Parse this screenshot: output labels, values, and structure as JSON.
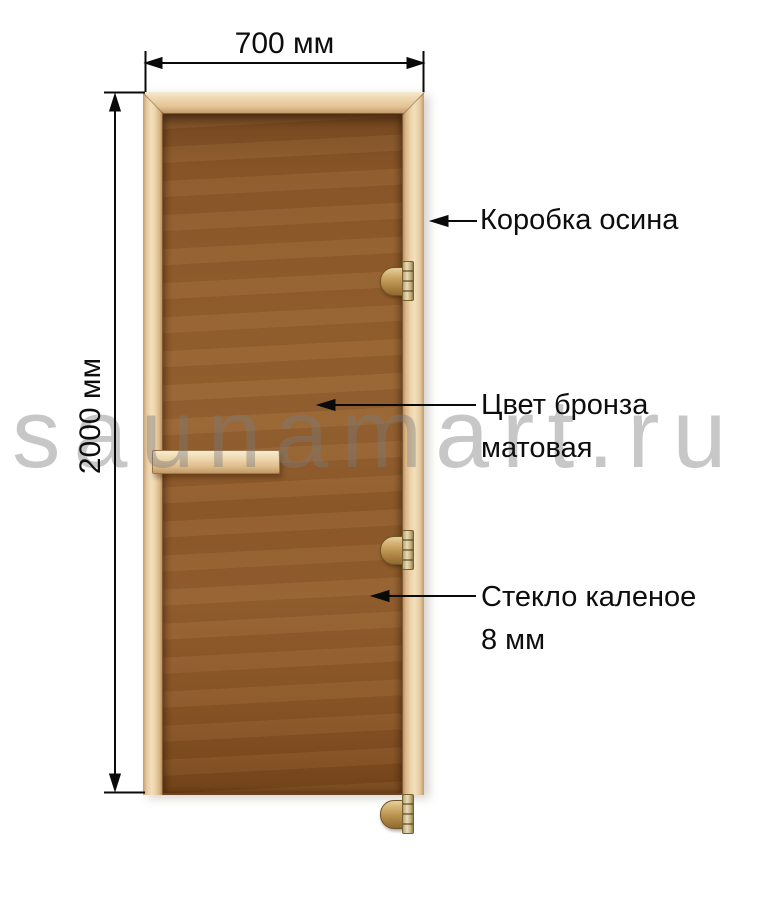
{
  "diagram": {
    "dimensions": {
      "width": "700 мм",
      "height": "2000 мм"
    },
    "annotations": [
      {
        "lines": [
          "Коробка осина"
        ]
      },
      {
        "lines": [
          "Цвет бронза",
          "матовая"
        ]
      },
      {
        "lines": [
          "Стекло каленое",
          "8 мм"
        ]
      }
    ],
    "watermark": "saunamart.ru",
    "door": {
      "hinge_count": 3
    },
    "colors": {
      "frame_wood": "#ecd2a9",
      "glass_bronze": "#8f5c2b",
      "hinge_brass": "#c2995a",
      "annotation_text": "#111111",
      "watermark_gray": "#c9c9c9"
    }
  }
}
